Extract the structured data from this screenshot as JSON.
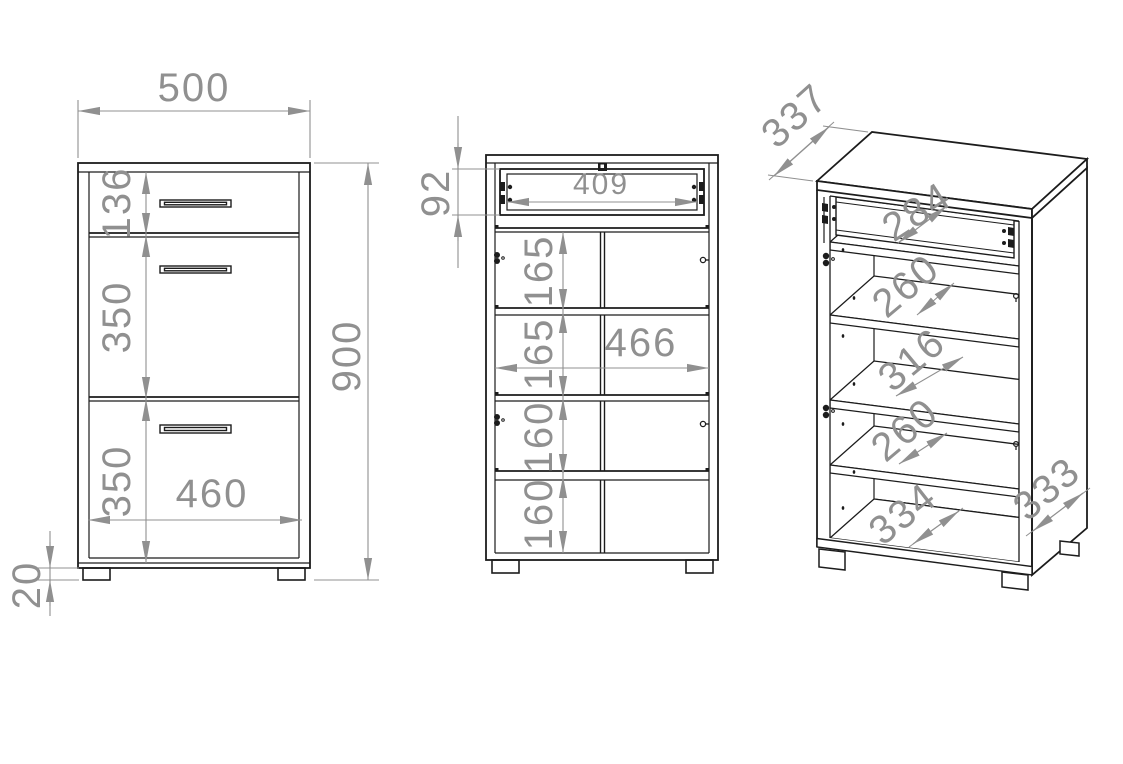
{
  "front_view": {
    "overall_width": "500",
    "overall_height": "900",
    "drawer_front_height": "136",
    "upper_door_height": "350",
    "lower_door_height": "350",
    "inner_width": "460",
    "foot_height": "20"
  },
  "open_view": {
    "drawer_opening_height": "92",
    "drawer_inner_width": "409",
    "compartment_1_height": "165",
    "compartment_2_height": "165",
    "compartment_3_height": "160",
    "compartment_4_height": "160",
    "inner_width": "466"
  },
  "iso_view": {
    "depth": "337",
    "drawer_clear_width": "284",
    "upper_shelf_gap": "260",
    "middle_shelf_gap": "316",
    "lower_shelf_gap": "260",
    "bottom_clear_width": "334",
    "inner_depth": "333"
  },
  "colors": {
    "line": "#1c1c1c",
    "dimension": "#909090",
    "background": "#ffffff"
  }
}
